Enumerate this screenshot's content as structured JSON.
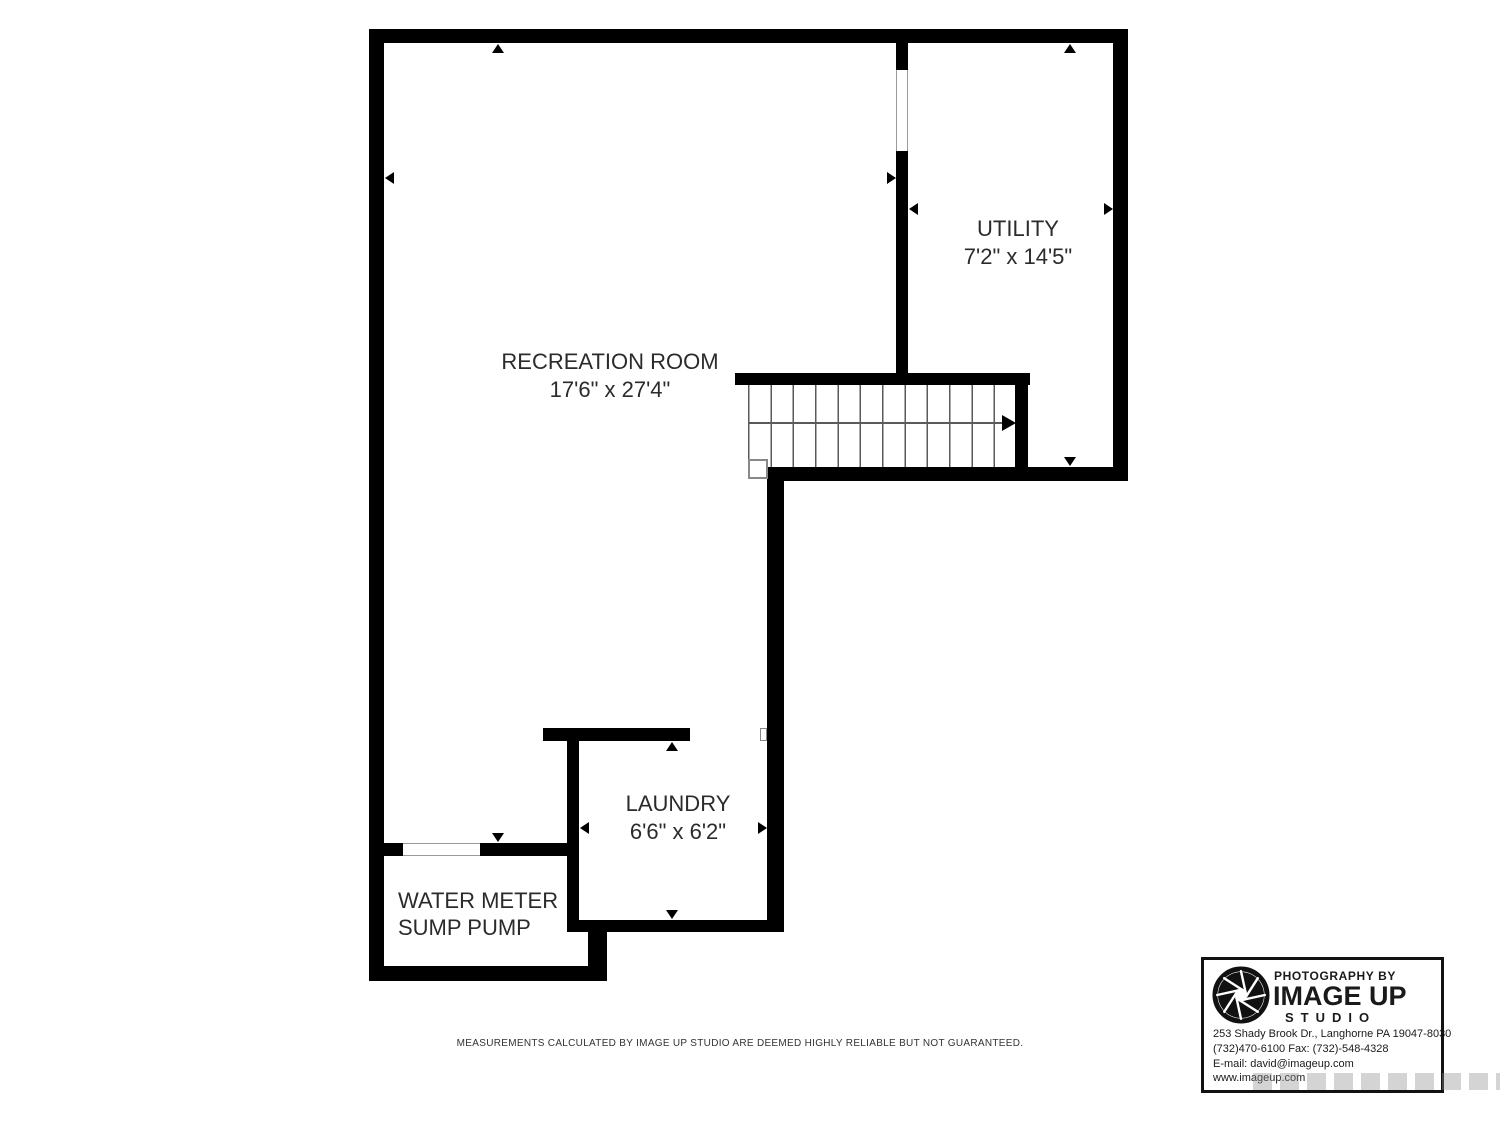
{
  "floor_plan": {
    "recreation_room": {
      "name": "RECREATION ROOM",
      "dims": "17'6\" x 27'4\""
    },
    "utility": {
      "name": "UTILITY",
      "dims": "7'2\" x 14'5\""
    },
    "laundry": {
      "name": "LAUNDRY",
      "dims": "6'6\" x 6'2\""
    },
    "water_meter_room": {
      "line1": "WATER METER",
      "line2": "SUMP PUMP"
    }
  },
  "footer": {
    "disclaimer": "MEASUREMENTS CALCULATED BY IMAGE UP STUDIO ARE DEEMED HIGHLY RELIABLE BUT NOT GUARANTEED."
  },
  "logo_box": {
    "tagline": "PHOTOGRAPHY BY",
    "brand": "IMAGE UP",
    "brand_sub": "STUDIO",
    "address": "253 Shady Brook Dr., Langhorne PA 19047-8030",
    "phone_fax": "(732)470-6100 Fax: (732)-548-4328",
    "email": "E-mail: david@imageup.com",
    "website": "www.imageup.com"
  },
  "colors": {
    "wall": "#000000",
    "room_label": "#2b2b2b",
    "logo_text": "#1a1a1a"
  }
}
